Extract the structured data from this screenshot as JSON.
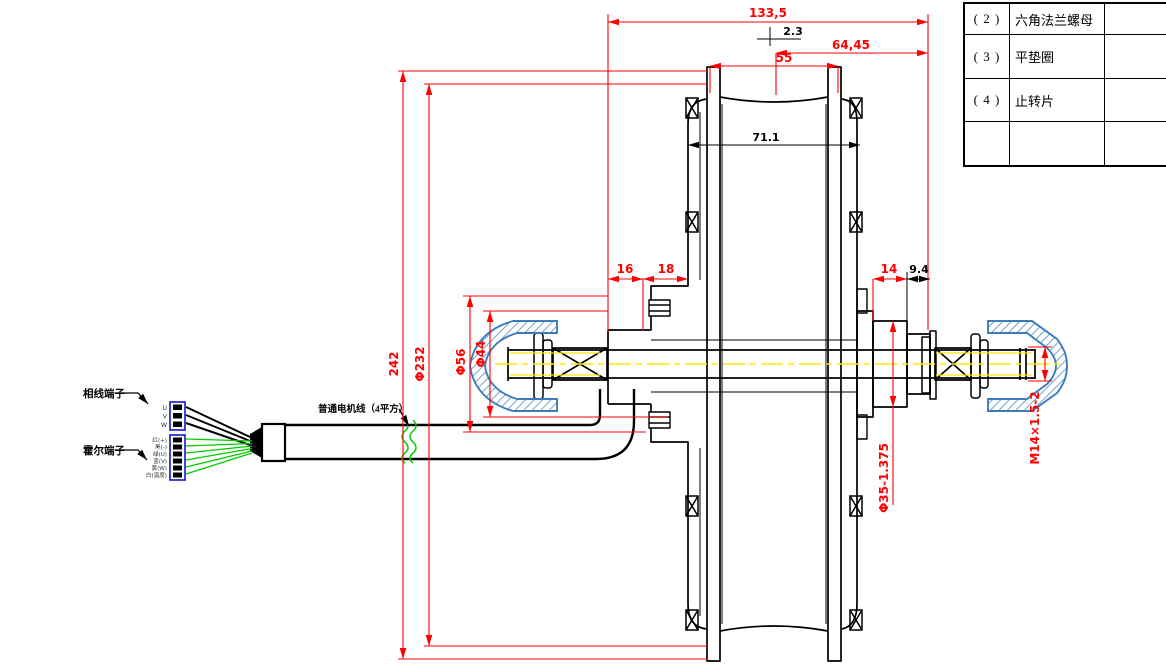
{
  "drawing_title": "hub-motor-section-engineering-drawing",
  "parts_table": {
    "rows": [
      {
        "no": "( 2 )",
        "name": "六角法兰螺母",
        "remark": ""
      },
      {
        "no": "( 3 )",
        "name": "平垫圈",
        "remark": ""
      },
      {
        "no": "( 4 )",
        "name": "止转片",
        "remark": ""
      },
      {
        "no": "",
        "name": "",
        "remark": ""
      }
    ]
  },
  "callouts": {
    "phase_terminal": "相线端子",
    "hall_terminal": "霍尔端子",
    "cable": "普通电机线（4平方）"
  },
  "phase_pins": [
    "U",
    "V",
    "W"
  ],
  "hall_pins": [
    "红(+)",
    "黑(-)",
    "绿(U)",
    "蓝(V)",
    "黄(W)",
    "白(温度)"
  ],
  "dimensions": {
    "d133_5": "133,5",
    "d2_3": "2.3",
    "d64_45": "64,45",
    "d55": "55",
    "d71_1": "71.1",
    "d16": "16",
    "d18": "18",
    "d14": "14",
    "d9_4": "9.4",
    "d242": "242",
    "d232": "Φ232",
    "d56": "Φ56",
    "d44": "Φ44",
    "d35": "Φ35-1.375",
    "m14": "M14×1.5-2"
  },
  "colors": {
    "dimension_red": "#ff0000",
    "centerline_yellow": "#ffe800",
    "hall_wire_green": "#00cc00",
    "cap_hatch_blue": "#3d7cb8",
    "connector_blue": "#1414cc"
  }
}
